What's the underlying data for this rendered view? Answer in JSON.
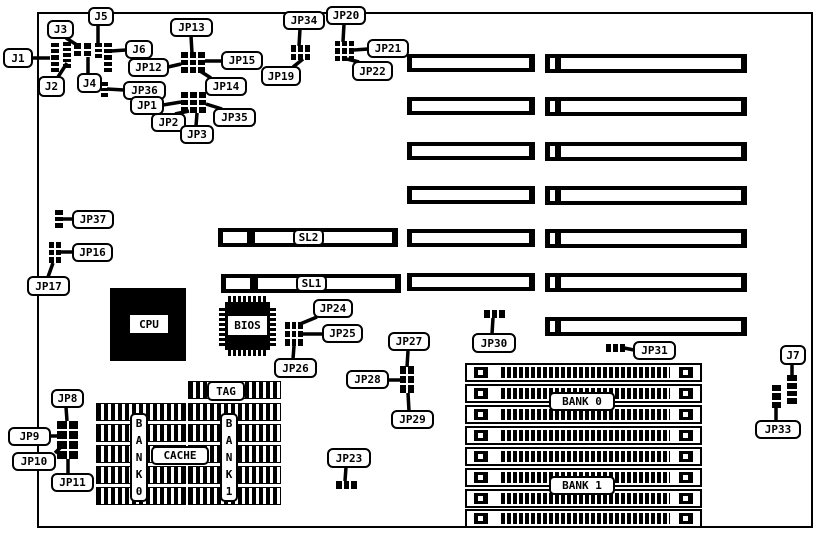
{
  "diagram": {
    "description": "motherboard jumper location diagram",
    "colors": {
      "background": "#ffffff",
      "ink": "#000000"
    },
    "board": {
      "x": 37,
      "y": 12,
      "w": 776,
      "h": 516
    },
    "callouts": [
      {
        "id": "j1",
        "label": "J1",
        "x": 3,
        "y": 48,
        "w": 30,
        "h": 20,
        "line": [
          33,
          58,
          50,
          58
        ]
      },
      {
        "id": "j2",
        "label": "J2",
        "x": 38,
        "y": 76,
        "w": 27,
        "h": 21,
        "line": [
          58,
          77,
          67,
          63
        ]
      },
      {
        "id": "j3",
        "label": "J3",
        "x": 47,
        "y": 20,
        "w": 27,
        "h": 19,
        "line": [
          66,
          38,
          77,
          45
        ]
      },
      {
        "id": "j4",
        "label": "J4",
        "x": 77,
        "y": 73,
        "w": 25,
        "h": 20,
        "line": [
          88,
          74,
          88,
          57
        ]
      },
      {
        "id": "j5",
        "label": "J5",
        "x": 88,
        "y": 7,
        "w": 26,
        "h": 19,
        "line": [
          98,
          25,
          98,
          43
        ]
      },
      {
        "id": "j6",
        "label": "J6",
        "x": 125,
        "y": 40,
        "w": 28,
        "h": 19,
        "line": [
          126,
          50,
          111,
          51
        ]
      },
      {
        "id": "jp12",
        "label": "JP12",
        "x": 128,
        "y": 58,
        "w": 41,
        "h": 19,
        "line": [
          168,
          67,
          181,
          64
        ]
      },
      {
        "id": "jp13",
        "label": "JP13",
        "x": 170,
        "y": 18,
        "w": 43,
        "h": 19,
        "line": [
          191,
          36,
          192,
          53
        ]
      },
      {
        "id": "jp15",
        "label": "JP15",
        "x": 221,
        "y": 51,
        "w": 42,
        "h": 19,
        "line": [
          222,
          61,
          205,
          61
        ]
      },
      {
        "id": "jp14",
        "label": "JP14",
        "x": 205,
        "y": 77,
        "w": 42,
        "h": 19,
        "line": [
          211,
          78,
          200,
          71
        ]
      },
      {
        "id": "jp19",
        "label": "JP19",
        "x": 261,
        "y": 66,
        "w": 40,
        "h": 20,
        "line": [
          293,
          67,
          303,
          59
        ]
      },
      {
        "id": "jp34",
        "label": "JP34",
        "x": 283,
        "y": 11,
        "w": 42,
        "h": 19,
        "line": [
          300,
          29,
          299,
          46
        ]
      },
      {
        "id": "jp20",
        "label": "JP20",
        "x": 326,
        "y": 6,
        "w": 40,
        "h": 19,
        "line": [
          344,
          24,
          343,
          42
        ]
      },
      {
        "id": "jp21",
        "label": "JP21",
        "x": 367,
        "y": 39,
        "w": 42,
        "h": 19,
        "line": [
          368,
          49,
          354,
          50
        ]
      },
      {
        "id": "jp22",
        "label": "JP22",
        "x": 352,
        "y": 61,
        "w": 41,
        "h": 20,
        "line": [
          359,
          62,
          347,
          59
        ]
      },
      {
        "id": "jp36",
        "label": "JP36",
        "x": 123,
        "y": 81,
        "w": 43,
        "h": 19,
        "line": [
          124,
          90,
          107,
          89
        ]
      },
      {
        "id": "jp1",
        "label": "JP1",
        "x": 130,
        "y": 96,
        "w": 34,
        "h": 19,
        "line": [
          163,
          105,
          181,
          102
        ]
      },
      {
        "id": "jp2",
        "label": "JP2",
        "x": 151,
        "y": 113,
        "w": 35,
        "h": 19,
        "line": [
          175,
          114,
          189,
          111
        ]
      },
      {
        "id": "jp3",
        "label": "JP3",
        "x": 180,
        "y": 125,
        "w": 34,
        "h": 19,
        "line": [
          196,
          126,
          197,
          113
        ]
      },
      {
        "id": "jp35",
        "label": "JP35",
        "x": 213,
        "y": 108,
        "w": 43,
        "h": 19,
        "line": [
          222,
          109,
          206,
          104
        ]
      },
      {
        "id": "jp37",
        "label": "JP37",
        "x": 72,
        "y": 210,
        "w": 42,
        "h": 19,
        "line": [
          73,
          219,
          62,
          219
        ]
      },
      {
        "id": "jp16",
        "label": "JP16",
        "x": 72,
        "y": 243,
        "w": 41,
        "h": 19,
        "line": [
          73,
          252,
          61,
          252
        ]
      },
      {
        "id": "jp17",
        "label": "JP17",
        "x": 27,
        "y": 276,
        "w": 43,
        "h": 20,
        "line": [
          48,
          277,
          53,
          263
        ]
      },
      {
        "id": "jp24",
        "label": "JP24",
        "x": 313,
        "y": 299,
        "w": 40,
        "h": 19,
        "line": [
          317,
          317,
          300,
          324
        ]
      },
      {
        "id": "jp25",
        "label": "JP25",
        "x": 322,
        "y": 324,
        "w": 41,
        "h": 19,
        "line": [
          323,
          334,
          303,
          334
        ]
      },
      {
        "id": "jp26",
        "label": "JP26",
        "x": 274,
        "y": 358,
        "w": 43,
        "h": 20,
        "line": [
          293,
          359,
          294,
          346
        ]
      },
      {
        "id": "jp27",
        "label": "JP27",
        "x": 388,
        "y": 332,
        "w": 42,
        "h": 19,
        "line": [
          408,
          351,
          407,
          367
        ]
      },
      {
        "id": "jp28",
        "label": "JP28",
        "x": 346,
        "y": 370,
        "w": 43,
        "h": 19,
        "line": [
          388,
          380,
          400,
          380
        ]
      },
      {
        "id": "jp29",
        "label": "JP29",
        "x": 391,
        "y": 410,
        "w": 43,
        "h": 19,
        "line": [
          409,
          411,
          408,
          393
        ]
      },
      {
        "id": "jp30",
        "label": "JP30",
        "x": 472,
        "y": 333,
        "w": 44,
        "h": 20,
        "line": [
          492,
          334,
          493,
          318
        ]
      },
      {
        "id": "jp31",
        "label": "JP31",
        "x": 633,
        "y": 341,
        "w": 43,
        "h": 19,
        "line": [
          634,
          350,
          624,
          348
        ]
      },
      {
        "id": "jp23",
        "label": "JP23",
        "x": 327,
        "y": 448,
        "w": 44,
        "h": 20,
        "line": [
          346,
          467,
          345,
          481
        ]
      },
      {
        "id": "jp8",
        "label": "JP8",
        "x": 51,
        "y": 389,
        "w": 33,
        "h": 19,
        "line": [
          66,
          407,
          67,
          421
        ]
      },
      {
        "id": "jp9",
        "label": "JP9",
        "x": 8,
        "y": 427,
        "w": 43,
        "h": 19,
        "line": [
          50,
          436,
          57,
          436
        ]
      },
      {
        "id": "jp10",
        "label": "JP10",
        "x": 12,
        "y": 452,
        "w": 44,
        "h": 19,
        "line": [
          55,
          453,
          61,
          447
        ]
      },
      {
        "id": "jp11",
        "label": "JP11",
        "x": 51,
        "y": 473,
        "w": 43,
        "h": 19,
        "line": [
          68,
          473,
          68,
          459
        ]
      },
      {
        "id": "j7",
        "label": "J7",
        "x": 780,
        "y": 345,
        "w": 26,
        "h": 20,
        "line": [
          792,
          364,
          792,
          377
        ]
      },
      {
        "id": "jp33",
        "label": "JP33",
        "x": 755,
        "y": 420,
        "w": 46,
        "h": 19,
        "line": [
          776,
          421,
          776,
          407
        ]
      }
    ],
    "headers": [
      {
        "id": "j1",
        "x": 51,
        "y": 43,
        "w": 8,
        "h": 29,
        "rows": 5,
        "cols": 1
      },
      {
        "id": "j2",
        "x": 63,
        "y": 42,
        "w": 8,
        "h": 26,
        "rows": 5,
        "cols": 1
      },
      {
        "id": "j3",
        "x": 74,
        "y": 43,
        "w": 7,
        "h": 13,
        "rows": 2,
        "cols": 1
      },
      {
        "id": "j4",
        "x": 84,
        "y": 43,
        "w": 7,
        "h": 13,
        "rows": 2,
        "cols": 1
      },
      {
        "id": "j5",
        "x": 95,
        "y": 43,
        "w": 7,
        "h": 15,
        "rows": 3,
        "cols": 1
      },
      {
        "id": "j6",
        "x": 104,
        "y": 43,
        "w": 8,
        "h": 29,
        "rows": 5,
        "cols": 1
      },
      {
        "id": "jp36",
        "x": 101,
        "y": 82,
        "w": 7,
        "h": 15,
        "rows": 3,
        "cols": 1
      },
      {
        "id": "jp12-13-14-15",
        "x": 181,
        "y": 52,
        "w": 24,
        "h": 21,
        "rows": 3,
        "cols": 3
      },
      {
        "id": "jp1-2-3-35",
        "x": 181,
        "y": 92,
        "w": 25,
        "h": 21,
        "rows": 3,
        "cols": 3
      },
      {
        "id": "jp19-34",
        "x": 291,
        "y": 45,
        "w": 19,
        "h": 15,
        "rows": 2,
        "cols": 3
      },
      {
        "id": "jp20-21-22",
        "x": 335,
        "y": 41,
        "w": 19,
        "h": 20,
        "rows": 3,
        "cols": 3
      },
      {
        "id": "jp37",
        "x": 55,
        "y": 210,
        "w": 8,
        "h": 18,
        "rows": 3,
        "cols": 1
      },
      {
        "id": "jp16-17",
        "x": 49,
        "y": 242,
        "w": 12,
        "h": 21,
        "rows": 3,
        "cols": 2
      },
      {
        "id": "jp24-25-26",
        "x": 285,
        "y": 322,
        "w": 18,
        "h": 24,
        "rows": 3,
        "cols": 3
      },
      {
        "id": "jp27-28-29",
        "x": 400,
        "y": 366,
        "w": 14,
        "h": 27,
        "rows": 3,
        "cols": 2
      },
      {
        "id": "jp30",
        "x": 484,
        "y": 310,
        "w": 21,
        "h": 8,
        "rows": 1,
        "cols": 3
      },
      {
        "id": "jp31",
        "x": 606,
        "y": 344,
        "w": 19,
        "h": 8,
        "rows": 1,
        "cols": 3
      },
      {
        "id": "jp23",
        "x": 336,
        "y": 481,
        "w": 21,
        "h": 8,
        "rows": 1,
        "cols": 3
      },
      {
        "id": "j7",
        "x": 787,
        "y": 375,
        "w": 10,
        "h": 29,
        "rows": 4,
        "cols": 1
      },
      {
        "id": "jp33",
        "x": 772,
        "y": 385,
        "w": 9,
        "h": 23,
        "rows": 3,
        "cols": 1
      },
      {
        "id": "jp8-9-10-11",
        "x": 57,
        "y": 421,
        "w": 21,
        "h": 38,
        "rows": 4,
        "cols": 2
      }
    ],
    "slots": {
      "left": {
        "x": 407,
        "w": 128,
        "h": 18,
        "ys": [
          54,
          97,
          142,
          186,
          229,
          273
        ]
      },
      "right": {
        "x": 545,
        "w": 202,
        "h": 19,
        "ys": [
          54,
          97,
          142,
          186,
          229,
          273,
          317
        ]
      },
      "sl": [
        {
          "id": "sl2",
          "x": 218,
          "y": 228,
          "w": 180,
          "h": 19
        },
        {
          "id": "sl1",
          "x": 221,
          "y": 274,
          "w": 180,
          "h": 19
        }
      ]
    },
    "simm": {
      "x": 465,
      "w": 237,
      "h": 19,
      "ys": [
        363,
        384,
        405,
        426,
        447,
        468,
        489,
        509
      ]
    },
    "chips": {
      "cpu": {
        "x": 110,
        "y": 288,
        "w": 76,
        "h": 73
      },
      "bios": {
        "x": 225,
        "y": 302,
        "w": 45,
        "h": 48
      },
      "bios_pins": [
        {
          "o": "h",
          "x": 228,
          "y": 296,
          "w": 40,
          "h": 6
        },
        {
          "o": "h",
          "x": 228,
          "y": 350,
          "w": 40,
          "h": 6
        },
        {
          "o": "v",
          "x": 219,
          "y": 306,
          "w": 6,
          "h": 40
        },
        {
          "o": "v",
          "x": 270,
          "y": 306,
          "w": 6,
          "h": 40
        }
      ],
      "cache_left_rows": {
        "x": 96,
        "w": 90,
        "h": 18,
        "ys": [
          403,
          424,
          445,
          466,
          487
        ]
      },
      "cache_right_rows": {
        "x": 188,
        "w": 93,
        "h": 18,
        "ys": [
          381,
          403,
          424,
          445,
          466,
          487
        ]
      }
    },
    "boxlabels": [
      {
        "id": "sl2",
        "text": "SL2",
        "x": 293,
        "y": 229,
        "w": 31,
        "h": 17,
        "border": true
      },
      {
        "id": "sl1",
        "text": "SL1",
        "x": 296,
        "y": 275,
        "w": 31,
        "h": 17,
        "border": true
      },
      {
        "id": "cpu",
        "text": "CPU",
        "x": 130,
        "y": 315,
        "w": 38,
        "h": 18,
        "border": false
      },
      {
        "id": "bios",
        "text": "BIOS",
        "x": 228,
        "y": 316,
        "w": 39,
        "h": 19,
        "border": false
      },
      {
        "id": "tag",
        "text": "TAG",
        "x": 207,
        "y": 381,
        "w": 38,
        "h": 20,
        "border": true
      },
      {
        "id": "cache",
        "text": "CACHE",
        "x": 151,
        "y": 446,
        "w": 58,
        "h": 19,
        "border": true
      },
      {
        "id": "bank0",
        "text": "BANK 0",
        "x": 549,
        "y": 392,
        "w": 66,
        "h": 19,
        "border": true
      },
      {
        "id": "bank1",
        "text": "BANK 1",
        "x": 549,
        "y": 476,
        "w": 66,
        "h": 19,
        "border": true
      },
      {
        "id": "bank0-vertical",
        "text": "B\nA\nN\nK\n0",
        "x": 130,
        "y": 413,
        "w": 18,
        "h": 89,
        "border": true,
        "vertical": true
      },
      {
        "id": "bank1-vertical",
        "text": "B\nA\nN\nK\n1",
        "x": 220,
        "y": 413,
        "w": 18,
        "h": 89,
        "border": true,
        "vertical": true
      }
    ]
  }
}
